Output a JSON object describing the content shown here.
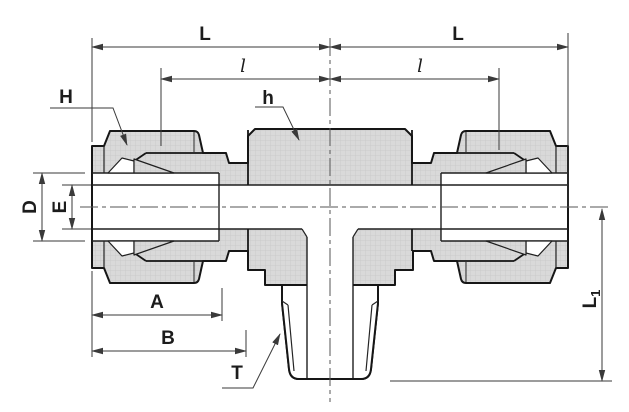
{
  "figure": {
    "title": "Male branch tee tube fitting - dimensioned cross-section drawing",
    "type": "engineering-cross-section",
    "view": "front section through main axis"
  },
  "labels": {
    "L_left": "L",
    "L_right": "L",
    "l_left": "l",
    "l_right": "l",
    "H": "H",
    "h": "h",
    "D": "D",
    "E": "E",
    "A": "A",
    "B": "B",
    "T": "T",
    "L1_main": "L",
    "L1_sub": "1"
  },
  "colors": {
    "background": "#ffffff",
    "body_fill": "#d9d9d9",
    "body_texture": "#c8c8c8",
    "outline": "#161616",
    "dimension_line": "#3a3a3a",
    "label_text": "#1c1c1c"
  }
}
